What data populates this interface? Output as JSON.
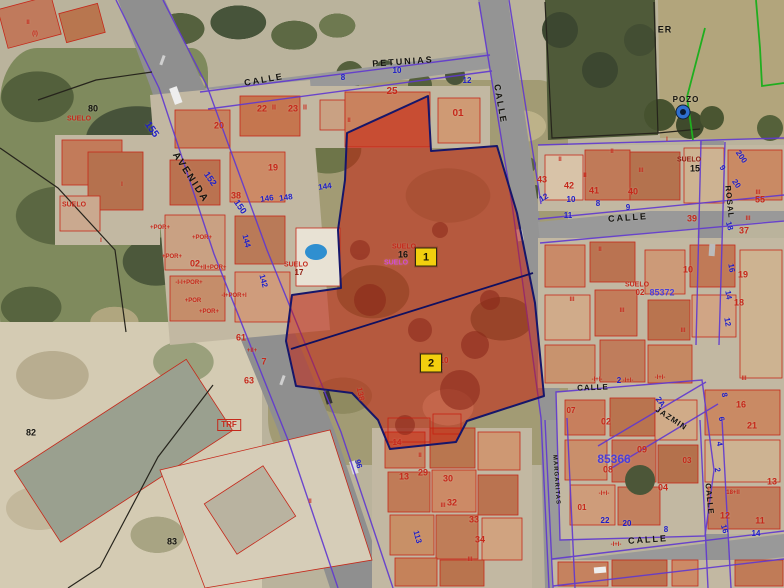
{
  "colors": {
    "red": "#c5281a",
    "darkred": "#8e1a0e",
    "blue": "#1d1dc8",
    "violet": "#4a3fd8",
    "black": "#15140f",
    "magenta": "#d24ad2",
    "green": "#1fae1f",
    "markerBg": "#f2cf0e"
  },
  "markers": [
    {
      "t": "1",
      "x": 426,
      "y": 257
    },
    {
      "t": "2",
      "x": 431,
      "y": 363
    }
  ],
  "labels": [
    {
      "t": "PETUNIAS",
      "x": 403,
      "y": 62,
      "c": "black",
      "s": 9,
      "ls": 2,
      "r": -4,
      "n": "street-label"
    },
    {
      "t": "CALLE",
      "x": 264,
      "y": 80,
      "c": "black",
      "s": 9,
      "ls": 2,
      "r": -10,
      "n": "street-label"
    },
    {
      "t": "CALLE",
      "x": 500,
      "y": 104,
      "c": "black",
      "s": 9,
      "ls": 2,
      "r": 80,
      "n": "street-label"
    },
    {
      "t": "AVENIDA",
      "x": 190,
      "y": 178,
      "c": "black",
      "s": 10,
      "ls": 2,
      "r": 57,
      "n": "street-label"
    },
    {
      "t": "CALLE",
      "x": 628,
      "y": 218,
      "c": "black",
      "s": 9,
      "ls": 2,
      "r": -4,
      "n": "street-label"
    },
    {
      "t": "ROSAL",
      "x": 729,
      "y": 202,
      "c": "black",
      "s": 8,
      "ls": 1,
      "r": 84,
      "n": "street-label"
    },
    {
      "t": "CALLE",
      "x": 593,
      "y": 388,
      "c": "black",
      "s": 8,
      "ls": 1,
      "r": -2,
      "n": "street-label"
    },
    {
      "t": "JAZMIN",
      "x": 671,
      "y": 419,
      "c": "black",
      "s": 8,
      "ls": 1,
      "r": 33,
      "n": "street-label"
    },
    {
      "t": "CALLE",
      "x": 648,
      "y": 540,
      "c": "black",
      "s": 9,
      "ls": 2,
      "r": -4,
      "n": "street-label"
    },
    {
      "t": "CALLE",
      "x": 709,
      "y": 499,
      "c": "black",
      "s": 8,
      "ls": 1,
      "r": 84,
      "n": "street-label"
    },
    {
      "t": "MARGARITAS",
      "x": 556,
      "y": 480,
      "c": "black",
      "s": 6,
      "ls": 1,
      "r": 86,
      "n": "street-label"
    },
    {
      "t": "ER",
      "x": 665,
      "y": 30,
      "c": "black",
      "s": 9,
      "ls": 1,
      "n": "land-label"
    },
    {
      "t": "POZO",
      "x": 686,
      "y": 100,
      "c": "black",
      "s": 8,
      "ls": 1,
      "n": "well-label"
    },
    {
      "t": "80",
      "x": 93,
      "y": 109,
      "c": "black",
      "s": 9,
      "n": "parcel-number"
    },
    {
      "t": "82",
      "x": 31,
      "y": 433,
      "c": "black",
      "s": 9,
      "n": "parcel-number"
    },
    {
      "t": "83",
      "x": 172,
      "y": 542,
      "c": "black",
      "s": 9,
      "n": "parcel-number"
    },
    {
      "t": "15",
      "x": 695,
      "y": 169,
      "c": "black",
      "s": 9,
      "n": "parcel-number"
    },
    {
      "t": "16",
      "x": 403,
      "y": 255,
      "c": "black",
      "s": 9,
      "n": "parcel-number"
    },
    {
      "t": "3",
      "x": 440,
      "y": 369,
      "c": "black",
      "s": 9,
      "n": "parcel-number"
    },
    {
      "t": "17",
      "x": 299,
      "y": 273,
      "c": "darkred",
      "s": 8,
      "n": "parcel-number"
    },
    {
      "t": "SUELO",
      "x": 79,
      "y": 119,
      "c": "red",
      "s": 7,
      "n": "suelo-label"
    },
    {
      "t": "SUELO",
      "x": 74,
      "y": 205,
      "c": "red",
      "s": 7,
      "n": "suelo-label"
    },
    {
      "t": "SUELO",
      "x": 296,
      "y": 265,
      "c": "red",
      "s": 7,
      "n": "suelo-label"
    },
    {
      "t": "SUELO",
      "x": 404,
      "y": 247,
      "c": "red",
      "s": 7,
      "n": "suelo-label"
    },
    {
      "t": "SUELO",
      "x": 637,
      "y": 285,
      "c": "red",
      "s": 7,
      "n": "suelo-label"
    },
    {
      "t": "SUELO",
      "x": 689,
      "y": 160,
      "c": "darkred",
      "s": 7,
      "n": "suelo-label"
    },
    {
      "t": "SUELO",
      "x": 396,
      "y": 263,
      "c": "magenta",
      "s": 7,
      "n": "suelo-label"
    },
    {
      "t": "10",
      "x": 444,
      "y": 361,
      "c": "red",
      "s": 8,
      "n": "parcel-number"
    },
    {
      "t": "20",
      "x": 219,
      "y": 126,
      "c": "red",
      "s": 9,
      "n": "parcel-number"
    },
    {
      "t": "22",
      "x": 262,
      "y": 109,
      "c": "red",
      "s": 9,
      "n": "parcel-number"
    },
    {
      "t": "II",
      "x": 274,
      "y": 108,
      "c": "red",
      "s": 7,
      "n": "floors-mark"
    },
    {
      "t": "23",
      "x": 293,
      "y": 109,
      "c": "red",
      "s": 9,
      "n": "parcel-number"
    },
    {
      "t": "II",
      "x": 305,
      "y": 108,
      "c": "red",
      "s": 7,
      "n": "floors-mark"
    },
    {
      "t": "25",
      "x": 392,
      "y": 92,
      "c": "red",
      "s": 10,
      "n": "parcel-number"
    },
    {
      "t": "01",
      "x": 458,
      "y": 114,
      "c": "red",
      "s": 10,
      "n": "parcel-number"
    },
    {
      "t": "19",
      "x": 273,
      "y": 168,
      "c": "red",
      "s": 9,
      "n": "parcel-number"
    },
    {
      "t": "38",
      "x": 236,
      "y": 196,
      "c": "red",
      "s": 9,
      "n": "parcel-number"
    },
    {
      "t": "02",
      "x": 195,
      "y": 264,
      "c": "red",
      "s": 9,
      "n": "parcel-number"
    },
    {
      "t": "61",
      "x": 241,
      "y": 338,
      "c": "red",
      "s": 9,
      "n": "parcel-number"
    },
    {
      "t": "7",
      "x": 264,
      "y": 362,
      "c": "red",
      "s": 9,
      "n": "parcel-number"
    },
    {
      "t": "63",
      "x": 249,
      "y": 381,
      "c": "red",
      "s": 9,
      "n": "parcel-number"
    },
    {
      "t": "138",
      "x": 360,
      "y": 394,
      "c": "red",
      "s": 8,
      "r": 78,
      "n": "parcel-number"
    },
    {
      "t": "43",
      "x": 542,
      "y": 180,
      "c": "red",
      "s": 9,
      "n": "parcel-number"
    },
    {
      "t": "42",
      "x": 569,
      "y": 186,
      "c": "red",
      "s": 9,
      "n": "parcel-number"
    },
    {
      "t": "41",
      "x": 594,
      "y": 191,
      "c": "red",
      "s": 9,
      "n": "parcel-number"
    },
    {
      "t": "40",
      "x": 633,
      "y": 192,
      "c": "red",
      "s": 9,
      "n": "parcel-number"
    },
    {
      "t": "39",
      "x": 692,
      "y": 219,
      "c": "red",
      "s": 9,
      "n": "parcel-number"
    },
    {
      "t": "55",
      "x": 760,
      "y": 200,
      "c": "red",
      "s": 9,
      "n": "parcel-number"
    },
    {
      "t": "37",
      "x": 744,
      "y": 231,
      "c": "red",
      "s": 9,
      "n": "parcel-number"
    },
    {
      "t": "10",
      "x": 688,
      "y": 270,
      "c": "red",
      "s": 9,
      "n": "parcel-number"
    },
    {
      "t": "19",
      "x": 743,
      "y": 275,
      "c": "red",
      "s": 9,
      "n": "parcel-number"
    },
    {
      "t": "18",
      "x": 739,
      "y": 303,
      "c": "red",
      "s": 9,
      "n": "parcel-number"
    },
    {
      "t": "07",
      "x": 571,
      "y": 411,
      "c": "red",
      "s": 8,
      "n": "parcel-number"
    },
    {
      "t": "02",
      "x": 606,
      "y": 422,
      "c": "red",
      "s": 9,
      "n": "parcel-number"
    },
    {
      "t": "09",
      "x": 642,
      "y": 450,
      "c": "red",
      "s": 9,
      "n": "parcel-number"
    },
    {
      "t": "03",
      "x": 687,
      "y": 461,
      "c": "red",
      "s": 8,
      "n": "parcel-number"
    },
    {
      "t": "08",
      "x": 608,
      "y": 470,
      "c": "red",
      "s": 9,
      "n": "parcel-number"
    },
    {
      "t": "04",
      "x": 663,
      "y": 488,
      "c": "red",
      "s": 9,
      "n": "parcel-number"
    },
    {
      "t": "01",
      "x": 582,
      "y": 508,
      "c": "red",
      "s": 8,
      "n": "parcel-number"
    },
    {
      "t": "16",
      "x": 741,
      "y": 405,
      "c": "red",
      "s": 9,
      "n": "parcel-number"
    },
    {
      "t": "21",
      "x": 752,
      "y": 426,
      "c": "red",
      "s": 9,
      "n": "parcel-number"
    },
    {
      "t": "13",
      "x": 772,
      "y": 482,
      "c": "red",
      "s": 9,
      "n": "parcel-number"
    },
    {
      "t": "12",
      "x": 725,
      "y": 516,
      "c": "red",
      "s": 9,
      "n": "parcel-number"
    },
    {
      "t": "11",
      "x": 760,
      "y": 521,
      "c": "red",
      "s": 9,
      "n": "parcel-number"
    },
    {
      "t": "14",
      "x": 397,
      "y": 443,
      "c": "red",
      "s": 8,
      "n": "parcel-number"
    },
    {
      "t": "13",
      "x": 404,
      "y": 477,
      "c": "red",
      "s": 9,
      "n": "parcel-number"
    },
    {
      "t": "29",
      "x": 423,
      "y": 473,
      "c": "red",
      "s": 9,
      "n": "parcel-number"
    },
    {
      "t": "30",
      "x": 448,
      "y": 479,
      "c": "red",
      "s": 9,
      "n": "parcel-number"
    },
    {
      "t": "32",
      "x": 452,
      "y": 503,
      "c": "red",
      "s": 9,
      "n": "parcel-number"
    },
    {
      "t": "33",
      "x": 474,
      "y": 520,
      "c": "red",
      "s": 9,
      "n": "parcel-number"
    },
    {
      "t": "34",
      "x": 480,
      "y": 540,
      "c": "red",
      "s": 9,
      "n": "parcel-number"
    },
    {
      "t": "02",
      "x": 640,
      "y": 293,
      "c": "red",
      "s": 8,
      "n": "parcel-number"
    },
    {
      "t": "18+II",
      "x": 733,
      "y": 493,
      "c": "red",
      "s": 6,
      "n": "construction-code"
    },
    {
      "t": "+POR+",
      "x": 160,
      "y": 228,
      "c": "red",
      "s": 6,
      "n": "construction-code"
    },
    {
      "t": "+POR+",
      "x": 202,
      "y": 238,
      "c": "red",
      "s": 6,
      "n": "construction-code"
    },
    {
      "t": "+POR+",
      "x": 172,
      "y": 257,
      "c": "red",
      "s": 6,
      "n": "construction-code"
    },
    {
      "t": "+II+POR+",
      "x": 213,
      "y": 268,
      "c": "red",
      "s": 6,
      "n": "construction-code"
    },
    {
      "t": "-I-I+POR+",
      "x": 189,
      "y": 283,
      "c": "red",
      "s": 6,
      "n": "construction-code"
    },
    {
      "t": "-I+POR+I",
      "x": 234,
      "y": 296,
      "c": "red",
      "s": 6,
      "n": "construction-code"
    },
    {
      "t": "+POR",
      "x": 193,
      "y": 301,
      "c": "red",
      "s": 6,
      "n": "construction-code"
    },
    {
      "t": "+POR+",
      "x": 209,
      "y": 312,
      "c": "red",
      "s": 6,
      "n": "construction-code"
    },
    {
      "t": "+II+",
      "x": 252,
      "y": 351,
      "c": "red",
      "s": 6,
      "n": "construction-code"
    },
    {
      "t": "-I+I-",
      "x": 597,
      "y": 380,
      "c": "red",
      "s": 6,
      "n": "construction-code"
    },
    {
      "t": "-I+I-",
      "x": 628,
      "y": 381,
      "c": "red",
      "s": 6,
      "n": "construction-code"
    },
    {
      "t": "-I+I-",
      "x": 660,
      "y": 378,
      "c": "red",
      "s": 6,
      "n": "construction-code"
    },
    {
      "t": "-I+I-",
      "x": 604,
      "y": 494,
      "c": "red",
      "s": 6,
      "n": "construction-code"
    },
    {
      "t": "-I+I-",
      "x": 616,
      "y": 545,
      "c": "red",
      "s": 6,
      "n": "construction-code"
    },
    {
      "t": "TRF",
      "x": 229,
      "y": 425,
      "c": "red",
      "s": 8,
      "bx": 1,
      "n": "transformer-label"
    },
    {
      "t": "II",
      "x": 349,
      "y": 121,
      "c": "red",
      "s": 6,
      "n": "floors-mark"
    },
    {
      "t": "II",
      "x": 560,
      "y": 160,
      "c": "red",
      "s": 6,
      "n": "floors-mark"
    },
    {
      "t": "II",
      "x": 585,
      "y": 176,
      "c": "red",
      "s": 6,
      "n": "floors-mark"
    },
    {
      "t": "II",
      "x": 612,
      "y": 152,
      "c": "red",
      "s": 6,
      "n": "floors-mark"
    },
    {
      "t": "III",
      "x": 641,
      "y": 171,
      "c": "red",
      "s": 6,
      "n": "floors-mark"
    },
    {
      "t": "II",
      "x": 600,
      "y": 250,
      "c": "red",
      "s": 6,
      "n": "floors-mark"
    },
    {
      "t": "III",
      "x": 572,
      "y": 300,
      "c": "red",
      "s": 6,
      "n": "floors-mark"
    },
    {
      "t": "III",
      "x": 622,
      "y": 311,
      "c": "red",
      "s": 6,
      "n": "floors-mark"
    },
    {
      "t": "III",
      "x": 683,
      "y": 331,
      "c": "red",
      "s": 6,
      "n": "floors-mark"
    },
    {
      "t": "II",
      "x": 420,
      "y": 456,
      "c": "red",
      "s": 6,
      "n": "floors-mark"
    },
    {
      "t": "III",
      "x": 443,
      "y": 506,
      "c": "red",
      "s": 6,
      "n": "floors-mark"
    },
    {
      "t": "III",
      "x": 470,
      "y": 560,
      "c": "red",
      "s": 6,
      "n": "floors-mark"
    },
    {
      "t": "II",
      "x": 310,
      "y": 502,
      "c": "red",
      "s": 6,
      "n": "floors-mark"
    },
    {
      "t": "II",
      "x": 28,
      "y": 23,
      "c": "red",
      "s": 6,
      "n": "floors-mark"
    },
    {
      "t": "(I)",
      "x": 35,
      "y": 34,
      "c": "red",
      "s": 6,
      "n": "floors-mark"
    },
    {
      "t": "I",
      "x": 122,
      "y": 185,
      "c": "red",
      "s": 6,
      "n": "floors-mark"
    },
    {
      "t": "I",
      "x": 101,
      "y": 241,
      "c": "red",
      "s": 6,
      "n": "floors-mark"
    },
    {
      "t": "III",
      "x": 758,
      "y": 193,
      "c": "red",
      "s": 6,
      "n": "floors-mark"
    },
    {
      "t": "III",
      "x": 748,
      "y": 219,
      "c": "red",
      "s": 6,
      "n": "floors-mark"
    },
    {
      "t": "III",
      "x": 744,
      "y": 379,
      "c": "red",
      "s": 6,
      "n": "floors-mark"
    },
    {
      "t": "I",
      "x": 667,
      "y": 140,
      "c": "red",
      "s": 6,
      "n": "floors-mark"
    },
    {
      "t": "155",
      "x": 151,
      "y": 130,
      "c": "blue",
      "s": 10,
      "r": 55,
      "n": "house-number"
    },
    {
      "t": "152",
      "x": 210,
      "y": 179,
      "c": "blue",
      "s": 9,
      "r": 55,
      "n": "house-number"
    },
    {
      "t": "150",
      "x": 240,
      "y": 207,
      "c": "blue",
      "s": 9,
      "r": 55,
      "n": "house-number"
    },
    {
      "t": "146",
      "x": 267,
      "y": 199,
      "c": "blue",
      "s": 8,
      "r": -8,
      "n": "house-number"
    },
    {
      "t": "148",
      "x": 286,
      "y": 198,
      "c": "blue",
      "s": 8,
      "r": -8,
      "n": "house-number"
    },
    {
      "t": "144",
      "x": 325,
      "y": 187,
      "c": "blue",
      "s": 8,
      "r": -8,
      "n": "house-number"
    },
    {
      "t": "144",
      "x": 246,
      "y": 241,
      "c": "blue",
      "s": 8,
      "r": 75,
      "n": "house-number"
    },
    {
      "t": "142",
      "x": 263,
      "y": 281,
      "c": "blue",
      "s": 8,
      "r": 75,
      "n": "house-number"
    },
    {
      "t": "113",
      "x": 417,
      "y": 537,
      "c": "blue",
      "s": 8,
      "r": 75,
      "n": "house-number"
    },
    {
      "t": "96",
      "x": 358,
      "y": 464,
      "c": "blue",
      "s": 8,
      "r": 75,
      "n": "house-number"
    },
    {
      "t": "8",
      "x": 343,
      "y": 78,
      "c": "blue",
      "s": 8,
      "n": "house-number"
    },
    {
      "t": "10",
      "x": 397,
      "y": 71,
      "c": "blue",
      "s": 8,
      "n": "house-number"
    },
    {
      "t": "12",
      "x": 467,
      "y": 81,
      "c": "blue",
      "s": 8,
      "n": "house-number"
    },
    {
      "t": "12",
      "x": 544,
      "y": 198,
      "c": "blue",
      "s": 8,
      "r": -30,
      "n": "house-number"
    },
    {
      "t": "10",
      "x": 571,
      "y": 200,
      "c": "blue",
      "s": 8,
      "n": "house-number"
    },
    {
      "t": "8",
      "x": 598,
      "y": 204,
      "c": "blue",
      "s": 8,
      "n": "house-number"
    },
    {
      "t": "9",
      "x": 628,
      "y": 208,
      "c": "blue",
      "s": 8,
      "n": "house-number"
    },
    {
      "t": "11",
      "x": 568,
      "y": 216,
      "c": "blue",
      "s": 8,
      "n": "house-number"
    },
    {
      "t": "200",
      "x": 741,
      "y": 157,
      "c": "blue",
      "s": 8,
      "r": 55,
      "n": "house-number"
    },
    {
      "t": "20",
      "x": 736,
      "y": 184,
      "c": "blue",
      "s": 8,
      "r": 55,
      "n": "house-number"
    },
    {
      "t": "9",
      "x": 722,
      "y": 168,
      "c": "blue",
      "s": 8,
      "r": 55,
      "n": "house-number"
    },
    {
      "t": "18",
      "x": 729,
      "y": 226,
      "c": "blue",
      "s": 8,
      "r": 75,
      "n": "house-number"
    },
    {
      "t": "16",
      "x": 731,
      "y": 268,
      "c": "blue",
      "s": 8,
      "r": 80,
      "n": "house-number"
    },
    {
      "t": "14",
      "x": 728,
      "y": 295,
      "c": "blue",
      "s": 8,
      "r": 80,
      "n": "house-number"
    },
    {
      "t": "12",
      "x": 727,
      "y": 322,
      "c": "blue",
      "s": 8,
      "r": 80,
      "n": "house-number"
    },
    {
      "t": "22",
      "x": 605,
      "y": 521,
      "c": "blue",
      "s": 8,
      "n": "house-number"
    },
    {
      "t": "20",
      "x": 627,
      "y": 524,
      "c": "blue",
      "s": 8,
      "n": "house-number"
    },
    {
      "t": "8",
      "x": 666,
      "y": 530,
      "c": "blue",
      "s": 8,
      "n": "house-number"
    },
    {
      "t": "16",
      "x": 724,
      "y": 529,
      "c": "blue",
      "s": 8,
      "r": 75,
      "n": "house-number"
    },
    {
      "t": "14",
      "x": 756,
      "y": 534,
      "c": "blue",
      "s": 8,
      "n": "house-number"
    },
    {
      "t": "2",
      "x": 717,
      "y": 470,
      "c": "blue",
      "s": 8,
      "r": 80,
      "n": "house-number"
    },
    {
      "t": "4",
      "x": 719,
      "y": 444,
      "c": "blue",
      "s": 8,
      "r": 80,
      "n": "house-number"
    },
    {
      "t": "6",
      "x": 721,
      "y": 419,
      "c": "blue",
      "s": 8,
      "r": 80,
      "n": "house-number"
    },
    {
      "t": "8",
      "x": 724,
      "y": 395,
      "c": "blue",
      "s": 8,
      "r": 80,
      "n": "house-number"
    },
    {
      "t": "2A",
      "x": 660,
      "y": 402,
      "c": "blue",
      "s": 8,
      "r": 55,
      "n": "house-number"
    },
    {
      "t": "2",
      "x": 619,
      "y": 381,
      "c": "blue",
      "s": 8,
      "n": "house-number"
    },
    {
      "t": "85366",
      "x": 614,
      "y": 459,
      "c": "violet",
      "s": 12,
      "w": 800,
      "n": "block-number"
    },
    {
      "t": "85372",
      "x": 662,
      "y": 293,
      "c": "violet",
      "s": 9,
      "w": 800,
      "n": "block-number"
    }
  ]
}
